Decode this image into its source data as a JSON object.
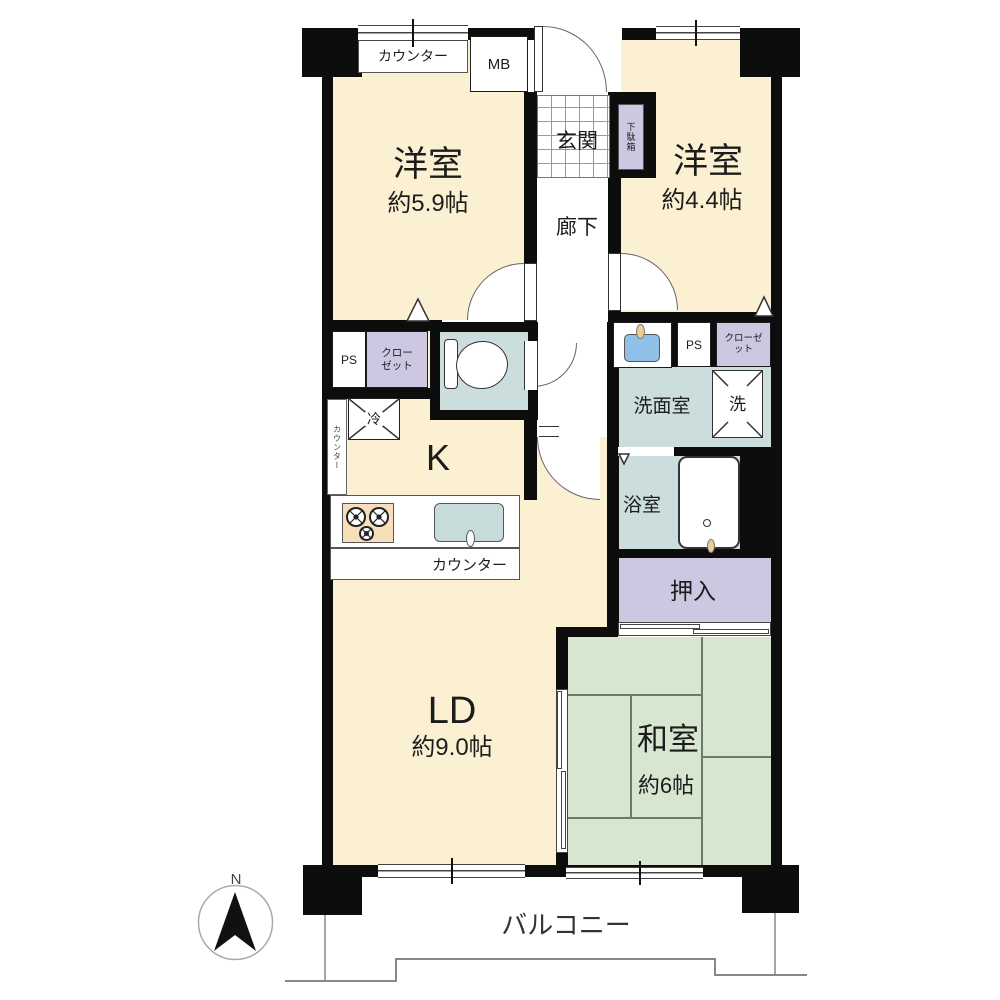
{
  "colors": {
    "wall": "#0d0d0d",
    "room_cream": "#FBF1D2",
    "tatami_green": "#D7E7CF",
    "closet_purple": "#CEC7E1",
    "wet_blue": "#CBDDDC",
    "sink_blue": "#90BFE8",
    "stove_tan": "#F7DFBC",
    "faucet_tan": "#E9CD92"
  },
  "rooms": {
    "western1": {
      "name": "洋室",
      "size": "約5.9帖"
    },
    "western2": {
      "name": "洋室",
      "size": "約4.4帖"
    },
    "living_dining": {
      "name": "LD",
      "size": "約9.0帖"
    },
    "japanese": {
      "name": "和室",
      "size": "約6帖"
    },
    "kitchen": {
      "name": "K"
    },
    "entrance": {
      "name": "玄関"
    },
    "hallway": {
      "name": "廊下"
    },
    "washroom": {
      "name": "洗面室"
    },
    "bathroom": {
      "name": "浴室"
    },
    "futon_closet": {
      "name": "押入"
    }
  },
  "fixtures": {
    "meter_box": "MB",
    "shoe_box": "下駄箱",
    "pipe_space_left": "PS",
    "pipe_space_right": "PS",
    "closet_left": "クローゼット",
    "closet_right": "クローゼット",
    "refrigerator": "冷",
    "washer": "洗",
    "counter_window": "カウンター",
    "counter_kitchen": "カウンター",
    "counter_side": "カウンター"
  },
  "outdoor": {
    "balcony": "バルコニー"
  },
  "compass": {
    "north": "N"
  }
}
